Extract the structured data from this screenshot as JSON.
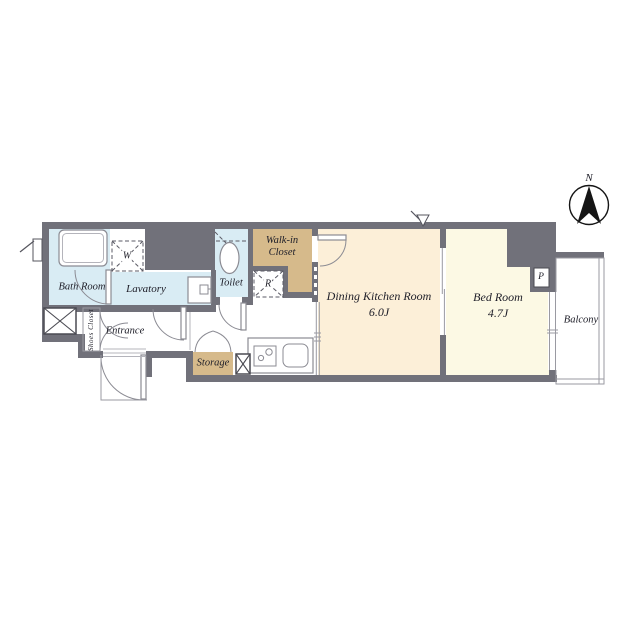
{
  "compass": {
    "north_label": "N"
  },
  "rooms": {
    "bath_room": "Bath Room",
    "lavatory": "Lavatory",
    "toilet": "Toilet",
    "walk_in_closet_line1": "Walk-in",
    "walk_in_closet_line2": "Closet",
    "dining_kitchen_name": "Dining Kitchen Room",
    "dining_kitchen_size": "6.0J",
    "bed_room_name": "Bed Room",
    "bed_room_size": "4.7J",
    "balcony": "Balcony",
    "entrance": "Entrance",
    "shoes_closet": "Shoes Closet",
    "storage": "Storage"
  },
  "markers": {
    "washing_machine": "W",
    "refrigerator": "R",
    "pipe_space": "P"
  },
  "colors": {
    "wall": "#71717a",
    "wet": "#d9ecf4",
    "tan": "#d6ba8b",
    "cream": "#fcefd8",
    "yellow": "#fcf9e4"
  }
}
